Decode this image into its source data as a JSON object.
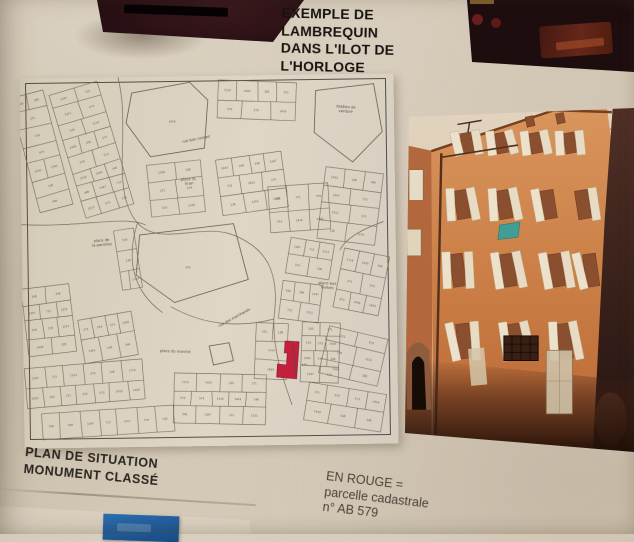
{
  "poster": {
    "title_lines": [
      "EXEMPLE DE",
      "LAMBREQUIN",
      "DANS L'ILOT DE",
      "L'HORLOGE"
    ],
    "caption_left_lines": [
      "PLAN DE SITUATION",
      "MONUMENT CLASSÉ"
    ],
    "caption_right_lines": [
      "EN ROUGE =",
      "parcelle cadastrale",
      "n° AB 579"
    ]
  },
  "map": {
    "street_labels": [
      {
        "text": "théâtre de verdure"
      },
      {
        "text": "place St. Vran"
      },
      {
        "text": "place de la paroisse"
      },
      {
        "text": "place aux herbes"
      },
      {
        "text": "place du marché"
      },
      {
        "text": "rue des marchands"
      },
      {
        "text": "rue de l'horloge"
      },
      {
        "text": "rue bon conseil"
      }
    ],
    "parcel_numbers": [
      "1429",
      "205",
      "271",
      "579",
      "573",
      "1416",
      "1443",
      "148",
      "346",
      "1347",
      "712",
      "1211",
      "575",
      "138",
      "1114"
    ],
    "red_parcel_color": "#c2203c"
  },
  "colors": {
    "poster_beige": "#d3c8b6",
    "map_paper": "#ded6c6",
    "red_parcel": "#c2203c",
    "blue_card": "#1d5c9b",
    "facade_orange": "#c5763f",
    "awning_teal": "#3f9e96",
    "dark_photo": "#270f13"
  }
}
